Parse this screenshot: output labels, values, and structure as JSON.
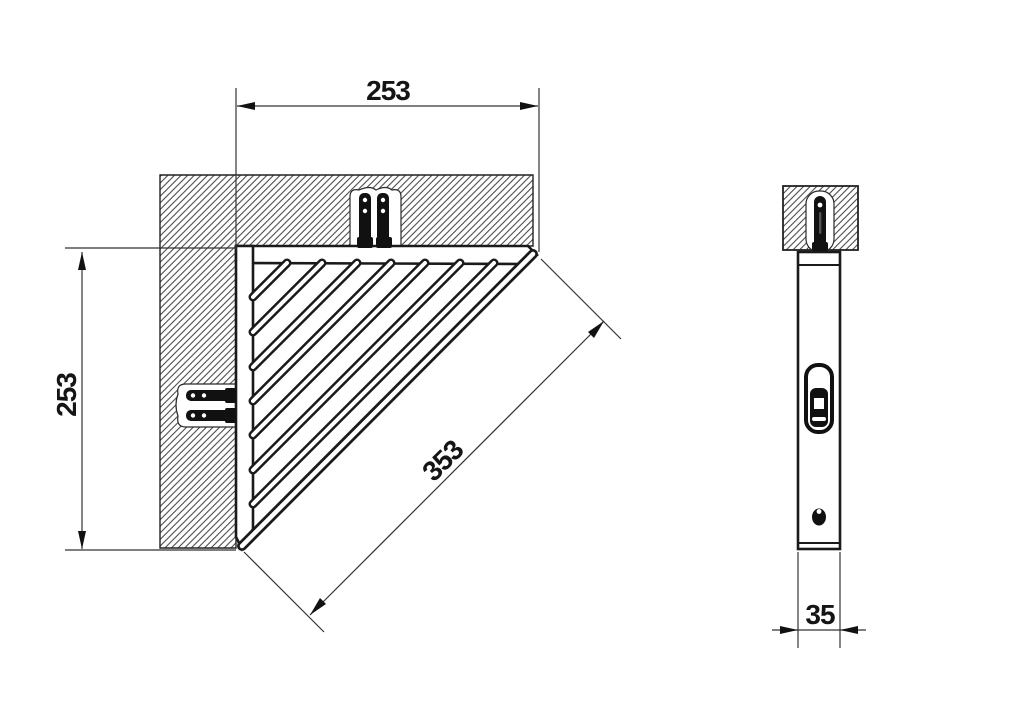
{
  "drawing": {
    "kind": "technical-dimension-drawing",
    "subject": "triangular corner basket shelf, plan view and side view",
    "colors": {
      "line": "#1a1a1a",
      "hatch": "#3a3a3a",
      "background": "#ffffff"
    },
    "views": {
      "plan": {
        "dim_width": "253",
        "dim_height": "253",
        "dim_diagonal": "353"
      },
      "side": {
        "dim_depth": "35"
      }
    }
  }
}
